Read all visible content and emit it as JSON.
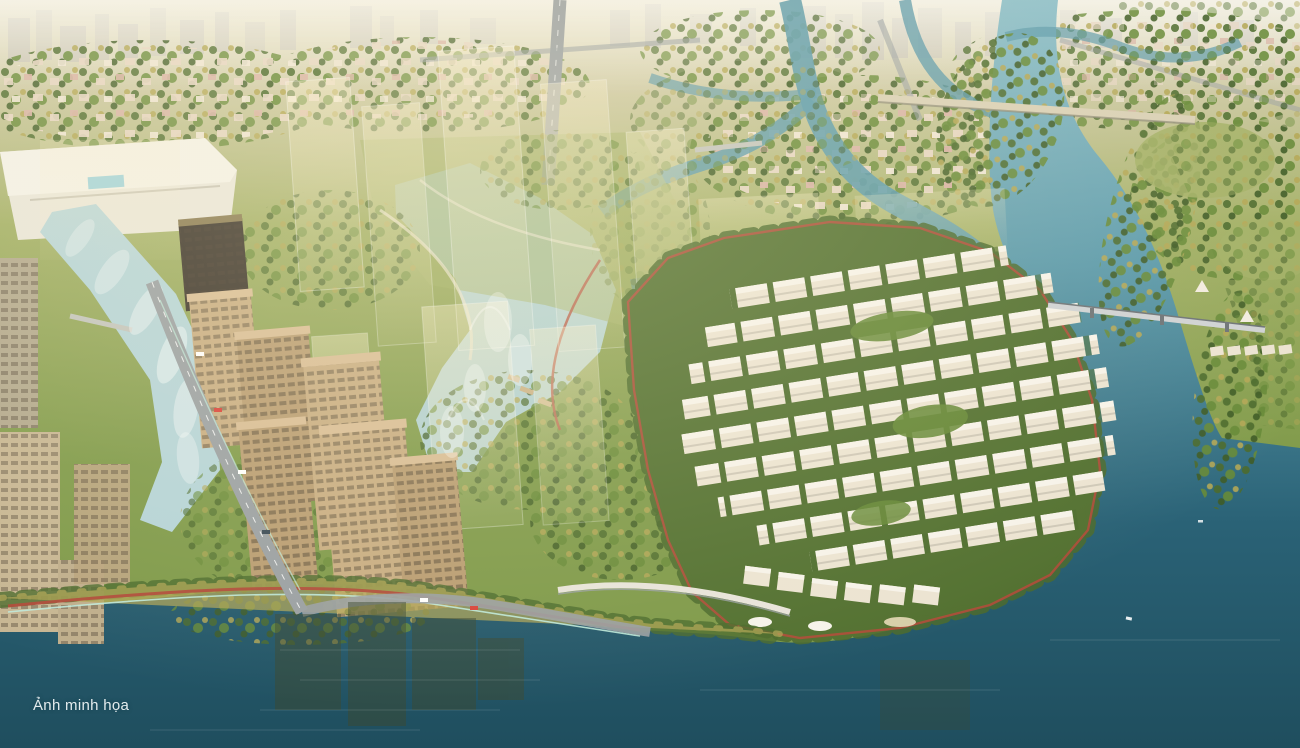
{
  "caption": {
    "text": "Ảnh minh họa"
  },
  "palette": {
    "haze": "#ddd6b8",
    "haze2": "#ccc8a2",
    "skyline": "#bfbaa9",
    "land": "#7f9a4a",
    "land_light": "#a3b066",
    "tree_dark": "#4c6b2d",
    "tree_mid": "#678a38",
    "tree_dark2": "#3f5c26",
    "tree_gold": "#b3a756",
    "water_light": "#8fc0ca",
    "water_mid": "#5b9aab",
    "water_deep": "#2a6276",
    "water_bottom": "#1f4e5e",
    "canal_light": "#b5d4d8",
    "villa": "#ece4d2",
    "villa_roof": "#f7f3ea",
    "tower_body": "#b99d72",
    "tower_face": "#c8ad82",
    "tower_roof": "#d8bd95",
    "tower_win": "#4a3f30",
    "tower_dark": "#3b342a",
    "road": "#9aa0a3",
    "path_red": "#b04c3a",
    "path_teal": "#bfe9da",
    "bridge": "#d9d0b6",
    "school_roof": "#666b6f",
    "ghost": "#f6ecc8",
    "reflection": "#3c4a31",
    "house1": "#e7d6c4",
    "house2": "#d9b3a6",
    "house3": "#f0e6d6",
    "caption_color": "#e4ecee"
  }
}
